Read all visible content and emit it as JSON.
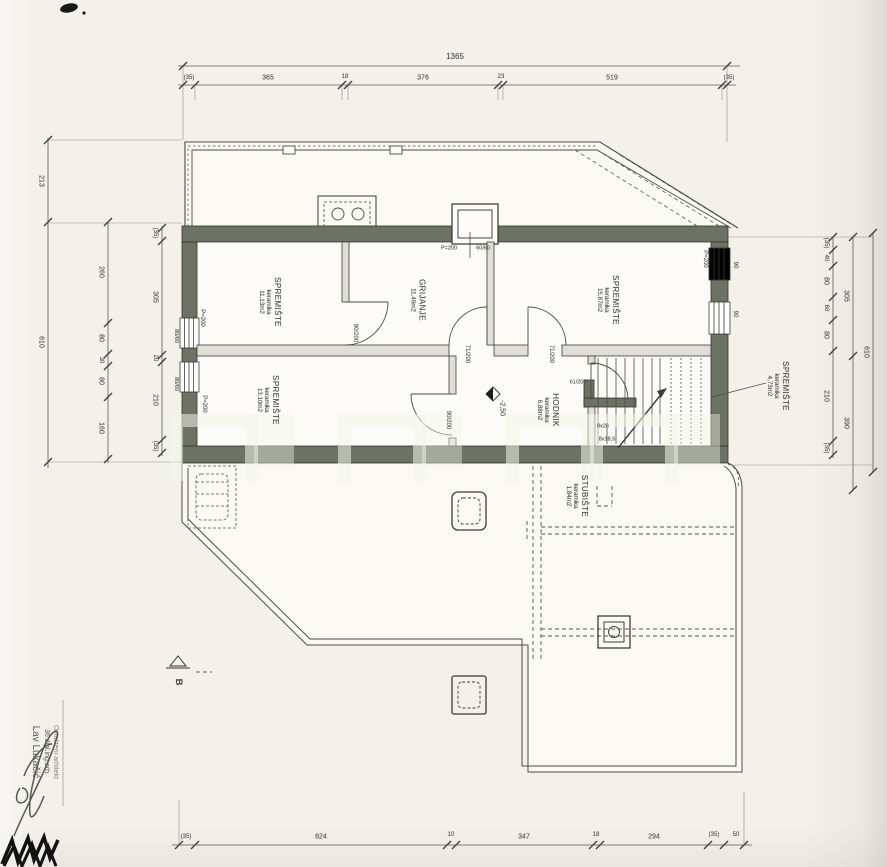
{
  "rooms": [
    {
      "name": "SPREMIŠTE",
      "material": "keramika",
      "area": "11,13m2"
    },
    {
      "name": "GRIJANJE",
      "material": "",
      "area": "11,46m2"
    },
    {
      "name": "SPREMIŠTE",
      "material": "keramika",
      "area": "15,87m2"
    },
    {
      "name": "SPREMIŠTE",
      "material": "keramika",
      "area": "13,10m2"
    },
    {
      "name": "HODNIK",
      "material": "keramika",
      "area": "6,88m2"
    },
    {
      "name": "STUBIŠTE",
      "material": "keramika",
      "area": "1,84m2"
    },
    {
      "name": "SPREMIŠTE",
      "material": "keramika",
      "area": "4,73m2"
    }
  ],
  "annotations": {
    "parapet": "P=200",
    "chimney_size": "60/60",
    "level": "-2,50",
    "door_a": "71/200",
    "door_b": "71/200",
    "door_c": "90/200",
    "door_d": "90/200",
    "door_e": "61/200",
    "window_right_1": "90",
    "window_right_2": "90",
    "window_left_1": "80/60",
    "window_left_2": "80/60",
    "stairs_treads": "8x26",
    "stairs_risers": "8x18,5",
    "section_mark": "B"
  },
  "dims": {
    "top_total": [
      "1365"
    ],
    "top": [
      "(35)",
      "365",
      "18",
      "376",
      "23",
      "519",
      "(35)"
    ],
    "bottom": [
      "(35)",
      "624",
      "10",
      "347",
      "18",
      "294",
      "(35)",
      "50"
    ],
    "left_outer": [
      "213",
      "610"
    ],
    "left_mid": [
      "260",
      "80",
      "30",
      "80",
      "160"
    ],
    "left_inner": [
      "(35)",
      "305",
      "20",
      "210",
      "(35)"
    ],
    "right_inner": [
      "(35)",
      "40",
      "80",
      "60",
      "80",
      "210",
      "(35)"
    ],
    "right_mid": [
      "305",
      "390"
    ],
    "right_outer": [
      "610"
    ]
  },
  "signature": {
    "name": "Lav Lukačić",
    "title": "36.dipl.ing.arh.",
    "subtitle": "Ovlašteni arhitekt"
  },
  "colors": {
    "wall": "#6d7364",
    "paper": "#f2f1ea",
    "ink": "#4b4d44"
  }
}
